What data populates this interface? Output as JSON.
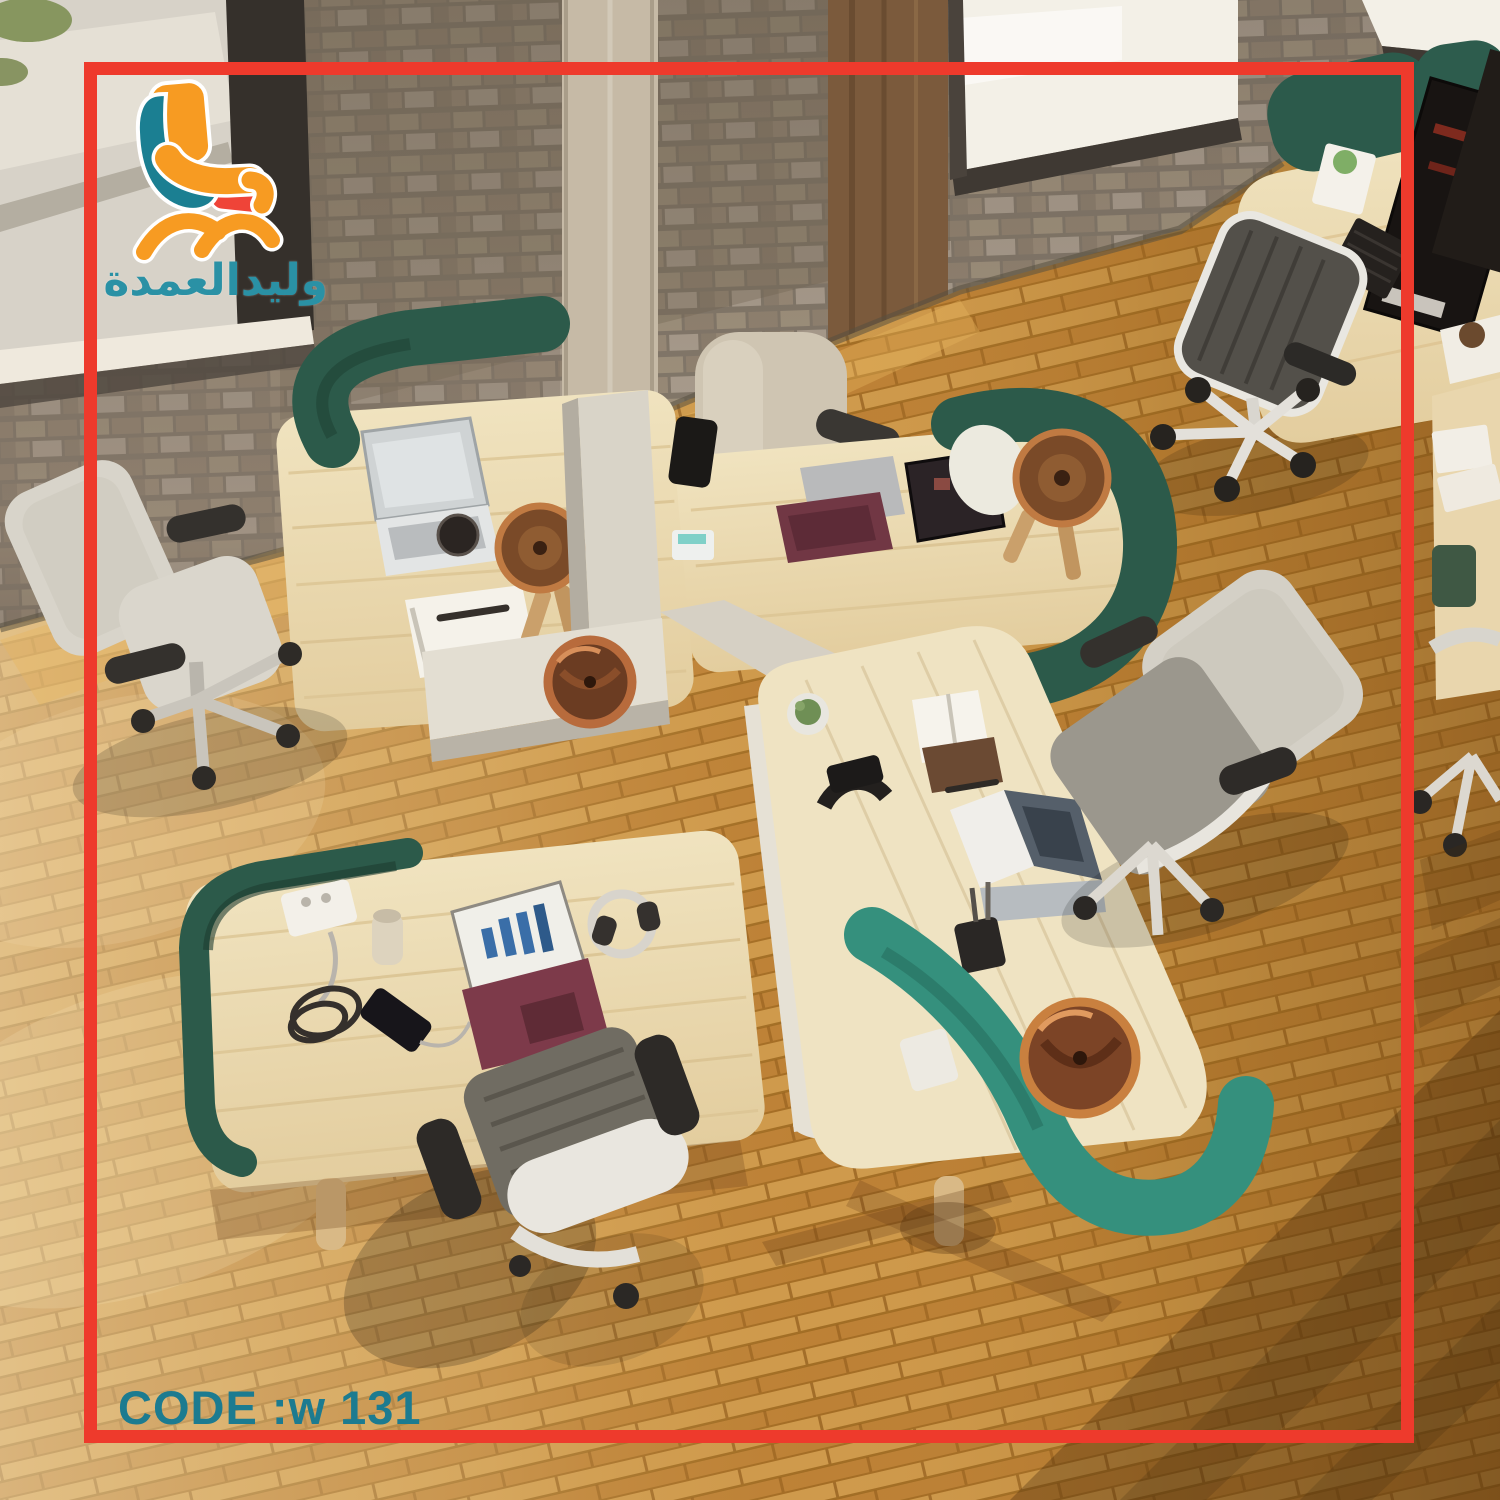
{
  "colors": {
    "accent_red": "#ee3a2c",
    "brand_teal": "#2a91a5",
    "code_teal": "#1c7b90",
    "logo_orange": "#f79b22",
    "logo_red": "#ef4438",
    "logo_teal": "#1b7f92",
    "screen_dark_green": "#2c5a4a",
    "screen_teal": "#35907d",
    "desk_wood": "#ecdcb6",
    "floor_wood": "#c8913f"
  },
  "logo": {
    "icon": "chair-logo-icon",
    "text": "وليدالعمدة"
  },
  "footer": {
    "code": "CODE :w 131"
  }
}
